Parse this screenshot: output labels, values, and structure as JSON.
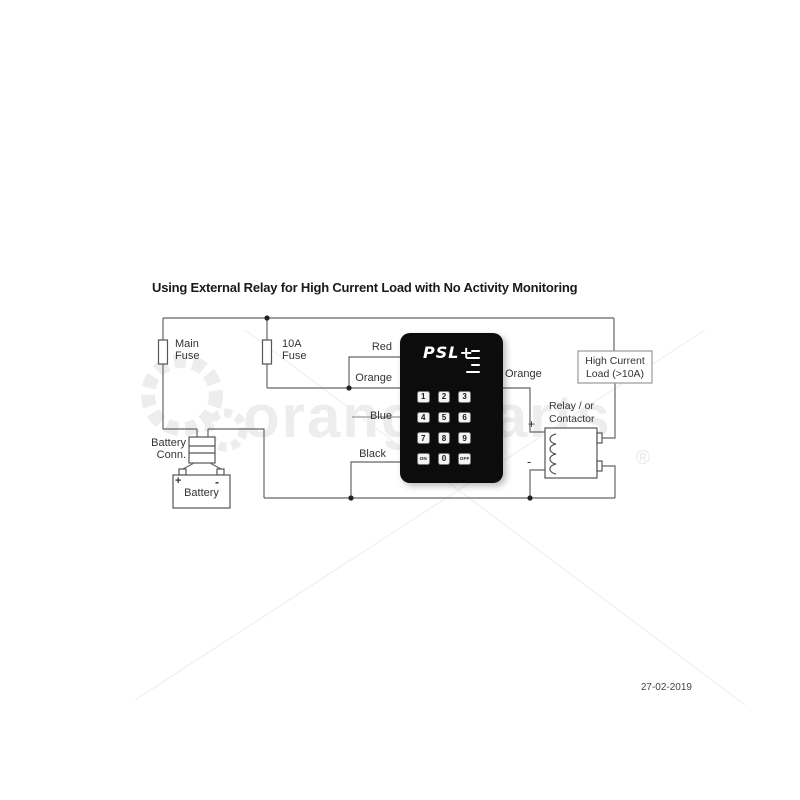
{
  "page": {
    "title": "Using External Relay for High Current Load with No Activity Monitoring",
    "date": "27-02-2019"
  },
  "watermark": {
    "text": "orangeparts",
    "registered": "®"
  },
  "wire_labels": {
    "red": "Red",
    "orange_left": "Orange",
    "blue": "Blue",
    "black": "Black",
    "orange_right": "Orange"
  },
  "fuses": {
    "main": {
      "line1": "Main",
      "line2": "Fuse"
    },
    "f10a": {
      "line1": "10A",
      "line2": "Fuse"
    }
  },
  "battery": {
    "conn_line1": "Battery",
    "conn_line2": "Conn.",
    "label": "Battery",
    "plus": "+",
    "minus": "-"
  },
  "load": {
    "line1": "High Current",
    "line2": "Load (>10A)"
  },
  "relay": {
    "line1": "Relay / or",
    "line2": "Contactor",
    "no": "NO",
    "nc": "NC",
    "c": "C",
    "plus": "+",
    "minus": "-"
  },
  "keypad": {
    "brand": "PSL+",
    "keys": [
      "1",
      "2",
      "3",
      "4",
      "5",
      "6",
      "7",
      "8",
      "9",
      "ON",
      "0",
      "OFF"
    ]
  },
  "colors": {
    "wire": "#666666",
    "keypad_bg": "#0c0c0c",
    "key_bg": "#f4f4f4",
    "label_text": "#333333",
    "watermark": "#ededed"
  }
}
